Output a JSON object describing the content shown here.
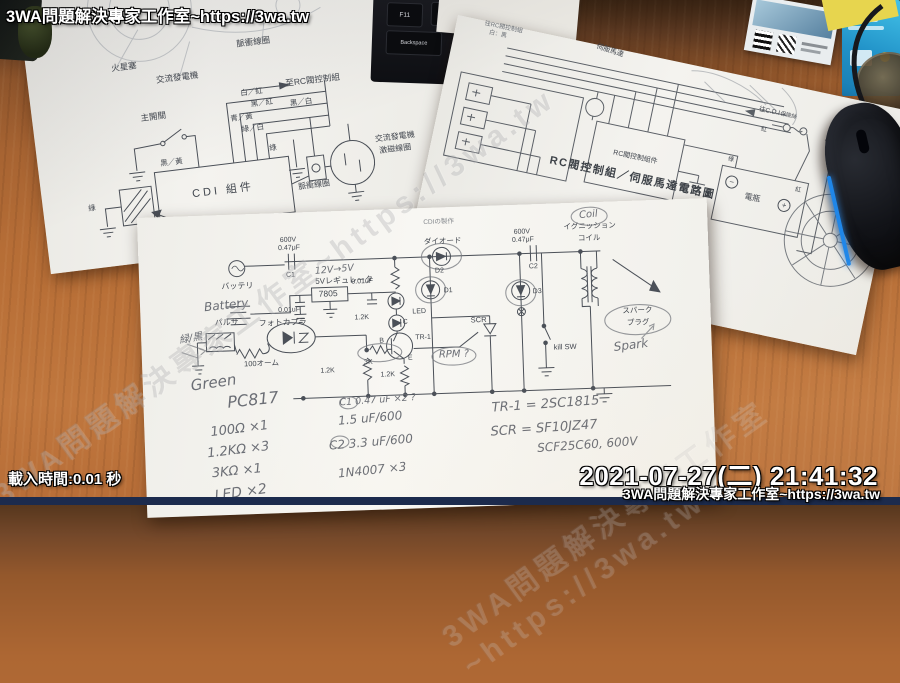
{
  "overlay": {
    "watermark_top": "3WA問題解決專家工作室~https://3wa.tw",
    "load_time": "載入時間:0.01 秒",
    "timestamp": "2021-07-27(二) 21:41:32",
    "watermark_bottom": "3WA問題解決專家工作室~https://3wa.tw",
    "watermark_diagonal": "3WA問題解決專家工作室~https://3wa.tw"
  },
  "colors": {
    "overlay_text": "#ffffff",
    "bottom_bar": "#1c2b4d",
    "mouse_led": "#2a8cf0",
    "desk_wood": "#b86f37"
  },
  "background": {
    "keys": [
      "F11",
      "F12",
      "Backspace"
    ]
  },
  "left_paper": {
    "spark_plug_top": "火星塞",
    "ac_generator_top": "交流發電機",
    "pulse_coil_top": "脈衝線圈",
    "to_rc_valve": "至RC閥控制組",
    "main_switch": "主開關",
    "wire_black_white": "黑／白",
    "wire_white_red": "白／紅",
    "wire_black_red": "黑／紅",
    "wire_blue_yellow": "青／黃",
    "wire_green_white": "綠／白",
    "wire_black_yellow": "黑／黃",
    "wire_green_1": "綠",
    "wire_green_2": "綠",
    "cdi_unit": "CDI 組件",
    "ignition_coil": "點火線圈",
    "pulse_coil_right": "脈衝線圈",
    "ac_generator_right": "交流發電機",
    "exciter_coil": "激磁線圈",
    "spark_plug_bottom": "火星塞"
  },
  "right_paper": {
    "caption_line1": "往RC閥控制組",
    "caption_line2": "白：黑",
    "servo_motor": "伺服馬達",
    "to_cdi": "往C.D.I",
    "rc_valve_unit": "RC閥控制組件",
    "fuse": "保險絲",
    "wire_red_top": "紅",
    "wire_red_bottom": "紅",
    "wire_green": "綠",
    "battery": "電瓶",
    "minus": "−",
    "plus": "+",
    "title": "RC閥控制組／伺服馬達電路圖",
    "page_number": "—23—"
  },
  "center_paper": {
    "typed": {
      "sheet_title": "CDIの製作",
      "c1_voltage": "600V",
      "c1_value": "0.47μF",
      "c1_label": "C1",
      "battery": "バッテリ",
      "regulator": "5Vレギュレータ",
      "regulator_ic": "7805",
      "cap_left": "0.01uF",
      "cap_right": "0.01uF",
      "pulser": "パルサ",
      "photocoupler": "フォトカプラ",
      "r_100": "100オーム",
      "r_12k_a": "1.2K",
      "r_12k_b": "1.2K",
      "r_12k_c": "1.2K",
      "r_3k": "3K",
      "led": "LED",
      "d1": "D1",
      "d2": "D2",
      "d3": "D3",
      "diode": "ダイオード",
      "c2_voltage": "600V",
      "c2_value": "0.47μF",
      "c2_label": "C2",
      "ignition_line1": "イグニッション",
      "ignition_line2": "コイル",
      "spark_line1": "スパーク",
      "spark_line2": "プラグ",
      "scr": "SCR",
      "kill_sw": "kill SW",
      "tr1": "TR-1",
      "tr_b": "B",
      "tr_c": "C",
      "tr_e": "E"
    },
    "handwritten": {
      "battery_en": "Battery",
      "wire_green_black": "緑/黒",
      "reg_note": "12V→5V",
      "green_en": "Green",
      "pc817": "PC817",
      "rpm_note": "RPM ?",
      "coil_en": "Coil",
      "spark_en": "Spark",
      "c1_note": "C1  0.47 uF ×2 ?",
      "c1_alt": "1.5 uF/600",
      "c2_note": "C2  3.3 uF/600",
      "diode_note": "1N4007 ×3",
      "parts": [
        "100Ω ×1",
        "1.2KΩ ×3",
        "3KΩ ×1",
        "LED ×2"
      ],
      "tr_note": "TR-1 = 2SC1815",
      "scr_note": "SCR = SF10JZ47",
      "scr_note2": "SCF25C60, 600V"
    }
  }
}
